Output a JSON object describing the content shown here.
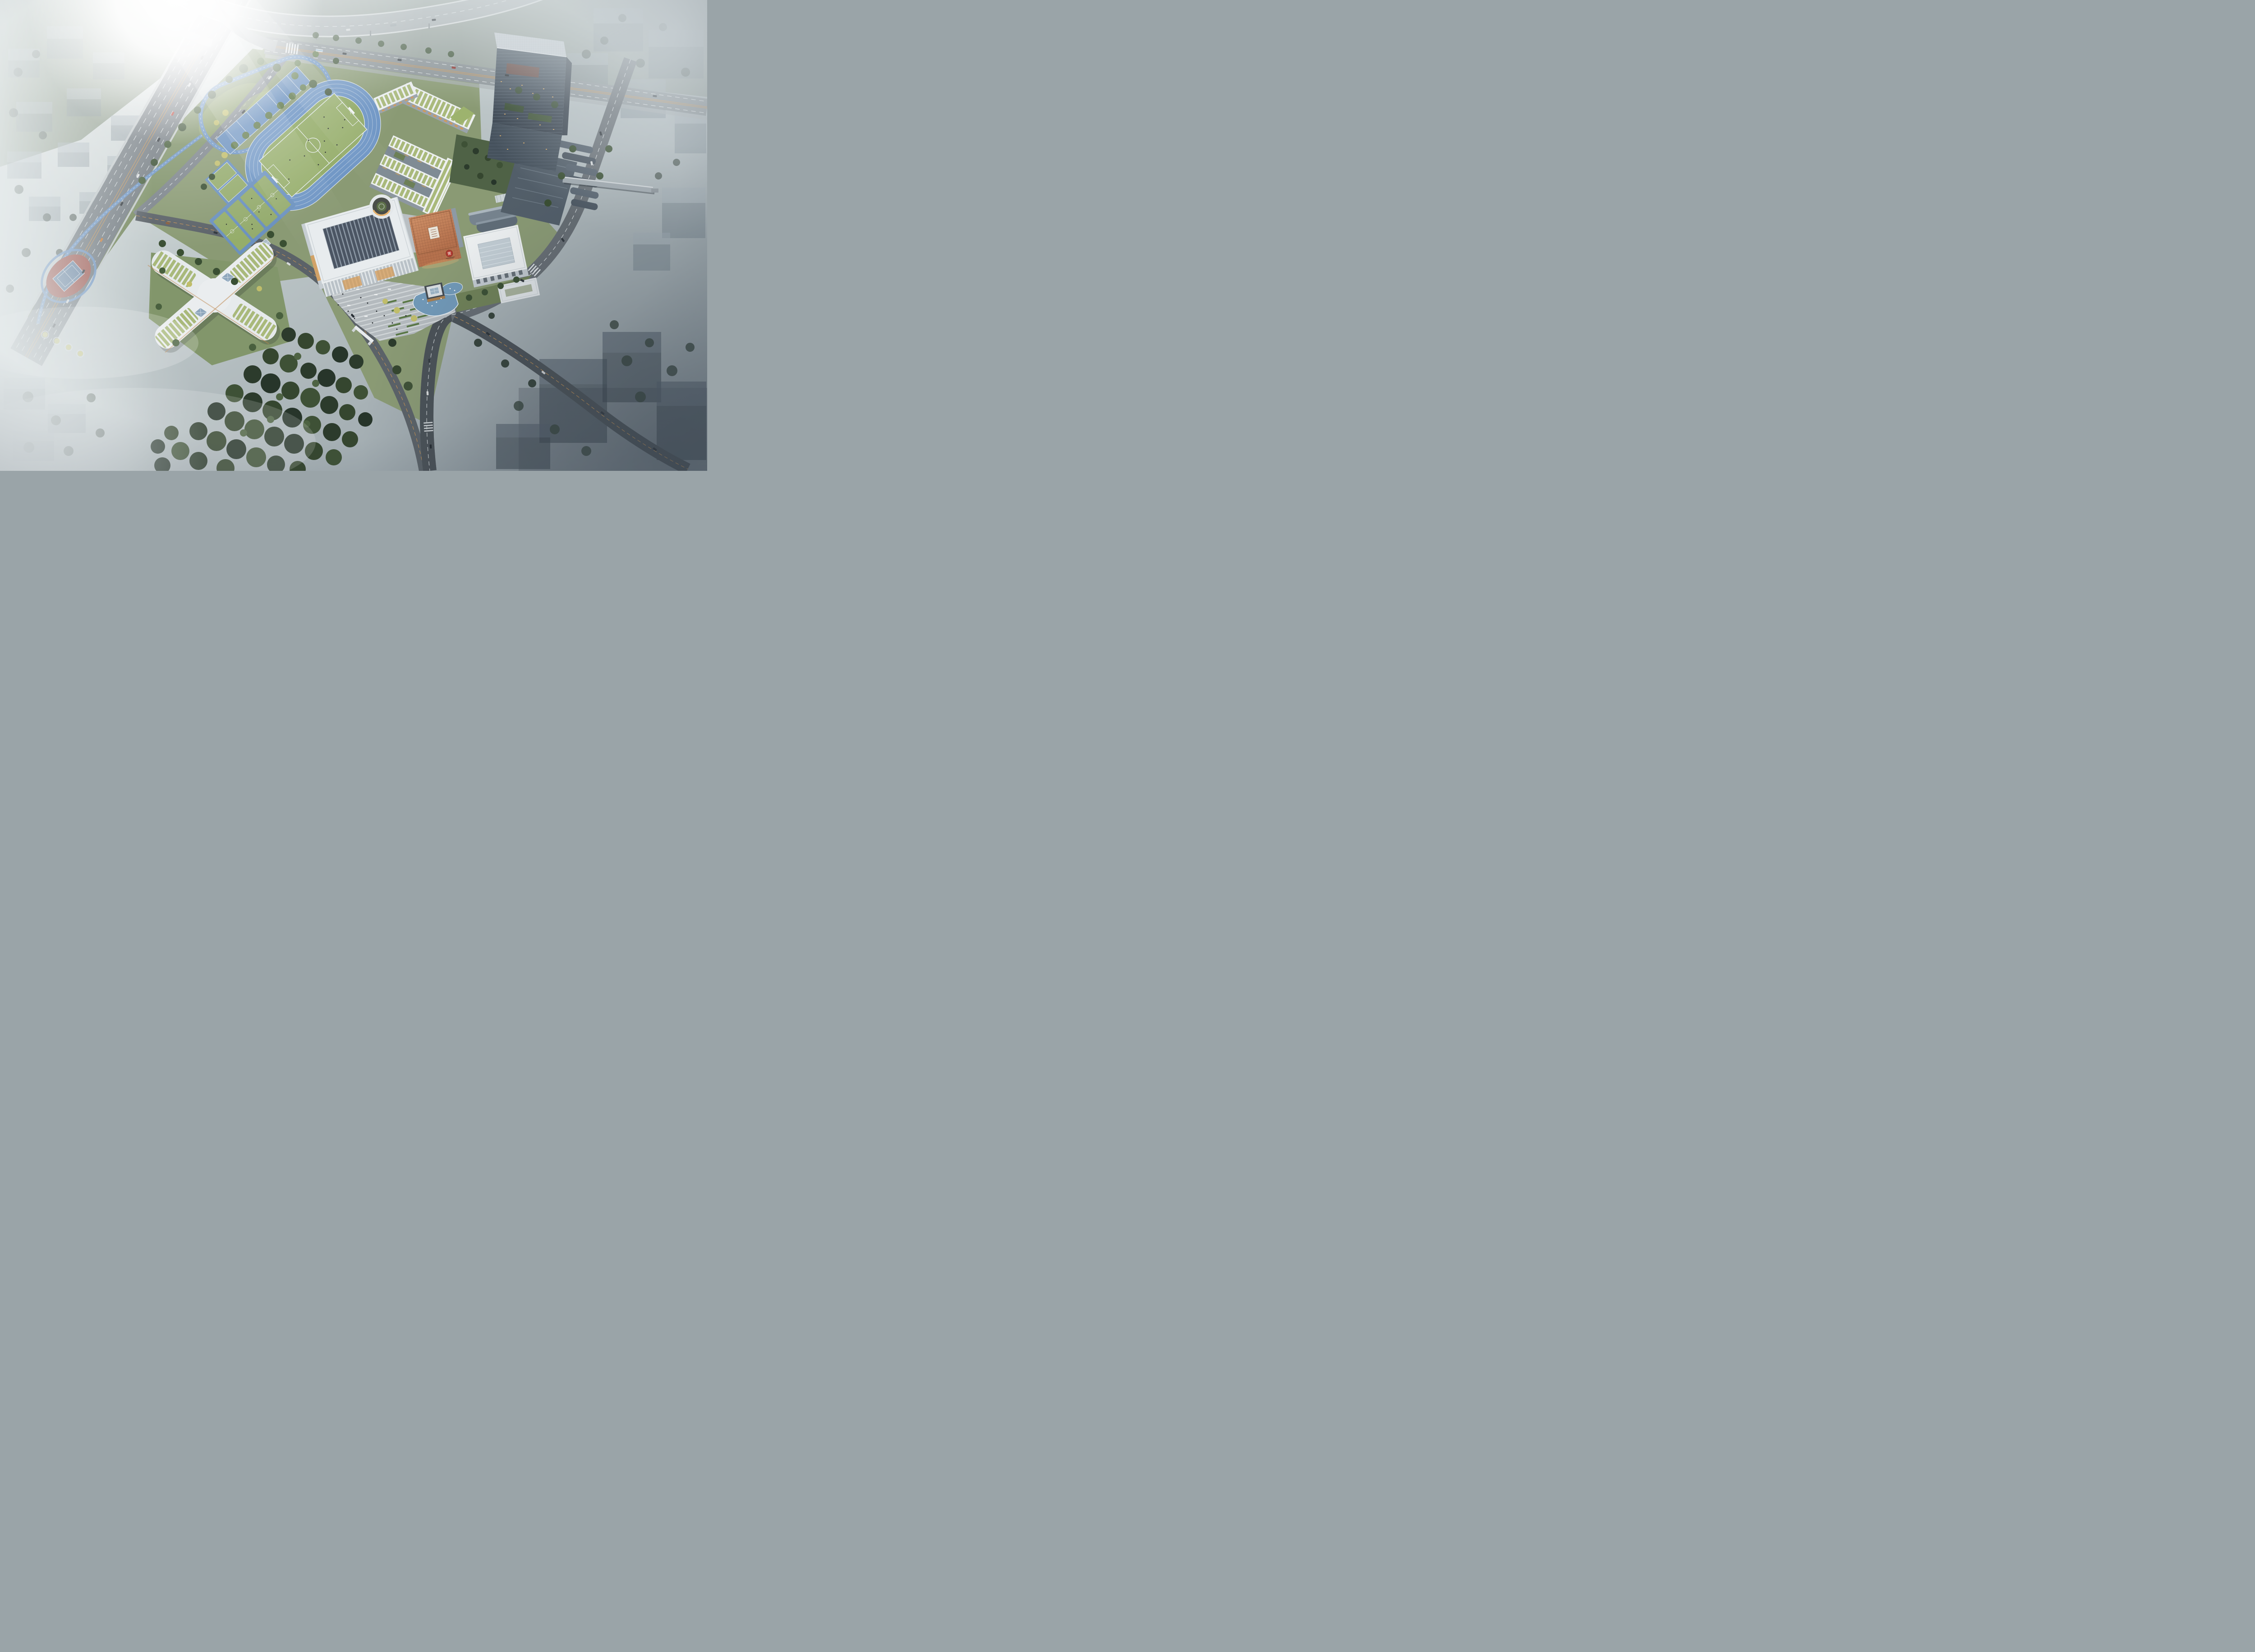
{
  "meta": {
    "title": "Aerial architectural rendering - school campus masterplan",
    "type": "birds-eye perspective render",
    "lighting": "overcast haze with strong sun glare top-left"
  },
  "emblem": {
    "character": "實",
    "description": "red circular seal logo on copper library facade"
  },
  "features": {
    "running_track_lanes": 6,
    "basketball_courts": 4,
    "soccer_goals": 2,
    "fountain_jets": 7,
    "kindergarten_wings": 4,
    "classroom_wings": 3
  },
  "palette": {
    "sky_light": "#e9edec",
    "sky_mid": "#c2cbcc",
    "sky_dark": "#8c979e",
    "sun": "#ffffff",
    "highway": "#747c82",
    "road": "#666d73",
    "road_dark": "#4a5157",
    "ramp": "#a8afb2",
    "lane_white": "#e9edef",
    "lane_orange": "#cf9752",
    "track_blue": "#6e95c4",
    "sports_blue": "#6b91bf",
    "infield_green": "#90a966",
    "pitch_green": "#95ad6a",
    "lawn": "#8a9a74",
    "park": "#7e9168",
    "kinder_lawn": "#82966b",
    "garden_dark": "#4f6246",
    "building_white": "#edf0f1",
    "green_roof": "#a9b97b",
    "facade": "#9aa3ab",
    "window_warm": "#d49a55",
    "copper_light": "#cf9168",
    "copper_mid": "#b5714d",
    "copper_dark": "#8a5638",
    "seal_red": "#b23b31",
    "glass_dark": "#39434e",
    "glass_mid": "#4d5a66",
    "terrace": "#56626e",
    "pond": "#7199b8",
    "plaza": "#b4babe",
    "court_red": "#a05a52",
    "court_blue": "#6b86a4",
    "canopy": "#aebecb",
    "saw_dark": "#4b5563",
    "fog": "#e8edee"
  }
}
